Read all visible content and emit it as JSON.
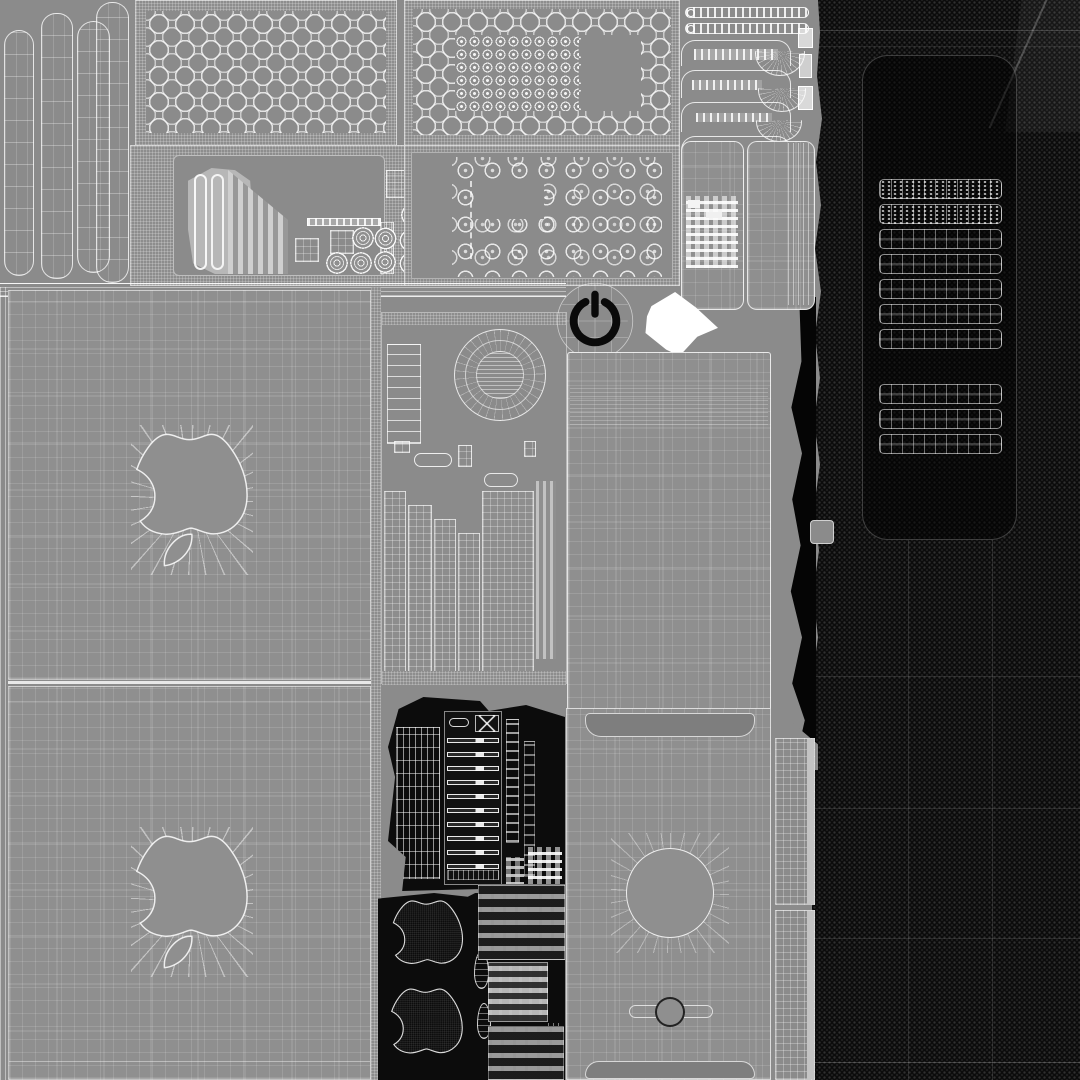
{
  "meta": {
    "kind": "uv-texture-atlas",
    "subject": "wireframe UV unwrap atlas of an Apple Mac Pro tower 3D model",
    "canvas": {
      "width": 1080,
      "height": 1080
    }
  },
  "colors": {
    "bg": "#8b8b8b",
    "panel": "#8f8f8f",
    "panel-dark": "#7e7e7e",
    "panel-light": "#b7b7b7",
    "black": "#0b0b0b",
    "ink": "#0a0a0a",
    "white": "#ffffff",
    "edge-light": "#c4c4c4"
  },
  "patterns": {
    "vent_rows_top": 7,
    "vent_rows_bottom": 3,
    "pcie_slot_bars": 10,
    "psu_coils": 8,
    "left_strips": 4,
    "apple_logo_count": 4
  },
  "icons": {
    "power": "power-icon",
    "apple": "apple-logo"
  }
}
